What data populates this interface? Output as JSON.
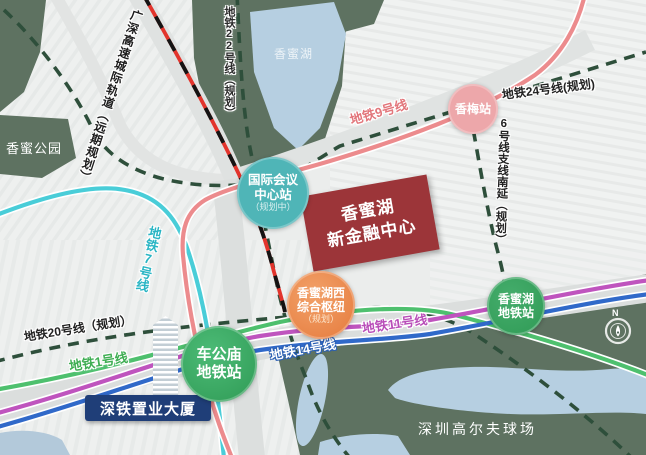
{
  "colors": {
    "landmark_red": "#9c3539",
    "tower_navy": "#1f3e78",
    "badge_teal": "#4fb5b7",
    "badge_pink": "#eda7aa",
    "badge_orange": "#ec8a4e",
    "badge_green": "#36a562",
    "line9_salmon": "#ec8b8d",
    "line7_cyan": "#49cdd8",
    "line1_green": "#4ec06e",
    "line11_magenta": "#bf54be",
    "line14_blue": "#3069c9",
    "planned_dash_green": "#2e4f3b",
    "intercity_rail_red": "#e2342c",
    "park_green": "#5e7261",
    "water_blue": "#b6cfe1"
  },
  "labels": {
    "park": "香蜜公园",
    "lake": "香蜜湖",
    "golf_course": "深圳高尔夫球场",
    "intercity_rail": "广深高速城际轨道（远期规划）",
    "tower": "深铁置业大厦",
    "compass_north": "N"
  },
  "metro_labels": {
    "line9": "地铁9号线",
    "line7": "地铁7号线",
    "line1": "地铁1号线",
    "line11": "地铁11号线",
    "line14": "地铁14号线",
    "line20": "地铁20号线（规划）",
    "line22": "地铁22号线（规划）",
    "line24": "地铁24号线(规划)",
    "line6_branch": "6号线支线南延（规划）"
  },
  "stations": {
    "intl_conference": {
      "line1": "国际会议",
      "line2": "中心站",
      "note": "（规划中）"
    },
    "xiangmei": {
      "name": "香梅站"
    },
    "west_hub": {
      "line1": "香蜜湖西",
      "line2": "综合枢纽",
      "note": "（规划）"
    },
    "chegongmiao": {
      "line1": "车公庙",
      "line2": "地铁站"
    },
    "xiangmihu": {
      "line1": "香蜜湖",
      "line2": "地铁站"
    }
  },
  "landmark": {
    "line1": "香蜜湖",
    "line2": "新金融中心"
  }
}
